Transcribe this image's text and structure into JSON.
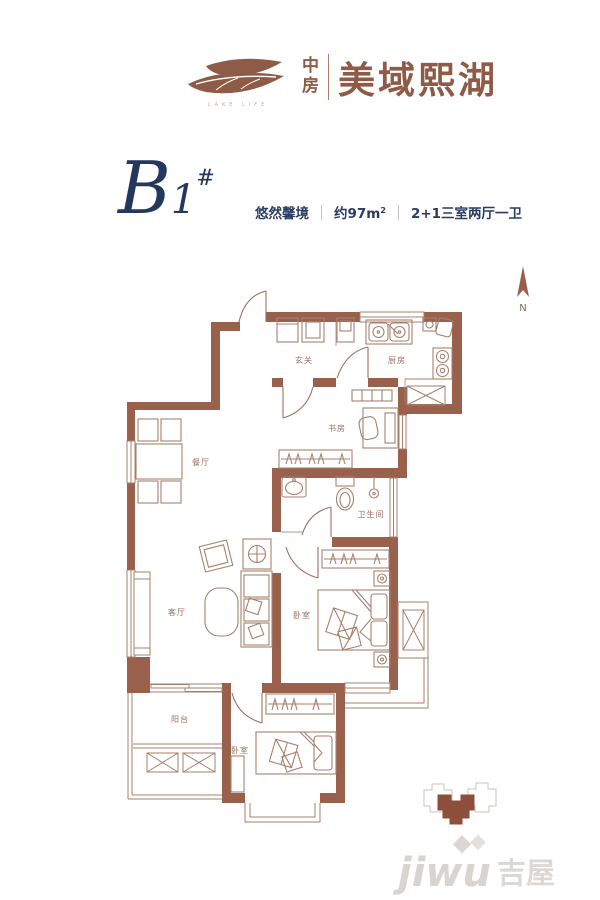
{
  "logo": {
    "brand_cn_top": "中",
    "brand_cn_bottom": "房",
    "name_cn": "美域熙湖",
    "tagline_en": "LAKE LIFE"
  },
  "title": {
    "letter": "B",
    "number": "1",
    "hash": "#",
    "slogan": "悠然馨境",
    "area_main": "约97m",
    "area_sup": "2",
    "layout": "2+1三室两厅一卫"
  },
  "compass": {
    "label": "N"
  },
  "rooms": {
    "entry": "玄关",
    "kitchen": "厨房",
    "study": "书房",
    "dining": "餐厅",
    "bath": "卫生间",
    "living": "客厅",
    "master": "卧室",
    "bedroom2": "卧室",
    "balcony": "阳台"
  },
  "watermark": {
    "latin": "jiwu",
    "cn": "吉屋"
  },
  "colors": {
    "wall_brown": "#99604C",
    "line_brown": "#A5806D",
    "label_brown": "#9A7260",
    "title_navy": "#24375C",
    "logo_brown": "#8D5B46",
    "keyplan_fill": "#8D4F3B",
    "watermark_gray": "#CBC6C1"
  }
}
